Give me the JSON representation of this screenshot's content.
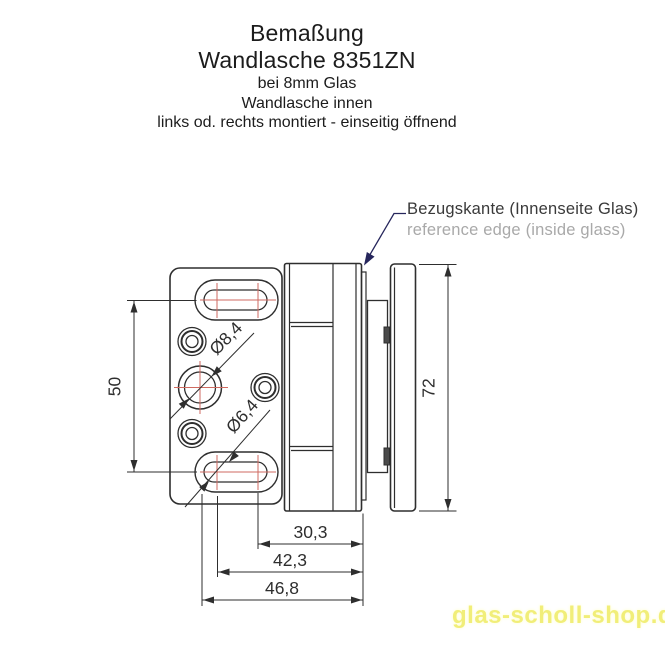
{
  "title": {
    "heading": "Bemaßung",
    "product": "Wandlasche 8351ZN",
    "sub1": "bei 8mm Glas",
    "sub2": "Wandlasche innen",
    "sub3": "links od. rechts montiert - einseitig öffnend"
  },
  "callout": {
    "label_de": "Bezugskante (Innenseite Glas)",
    "label_en": "reference edge (inside glass)"
  },
  "dimensions": {
    "vertical_hole_spacing_mm": "50",
    "overall_height_mm": "72",
    "ref_edge_to_near_slot_center_mm": "30,3",
    "ref_edge_to_far_slot_center_mm": "42,3",
    "ref_edge_to_slot_edge_mm": "46,8",
    "center_hole_diameter": "Ø8,4",
    "slot_hole_diameter": "Ø6,4"
  },
  "watermark": "glas-scholl-shop.de",
  "colors": {
    "line_dark": "#2e2e2e",
    "centerline_red": "#cf6a60",
    "leader_navy": "#26265c",
    "secondary_text_gray": "#a9a9a9",
    "watermark_yellow": "#f1ee79"
  }
}
